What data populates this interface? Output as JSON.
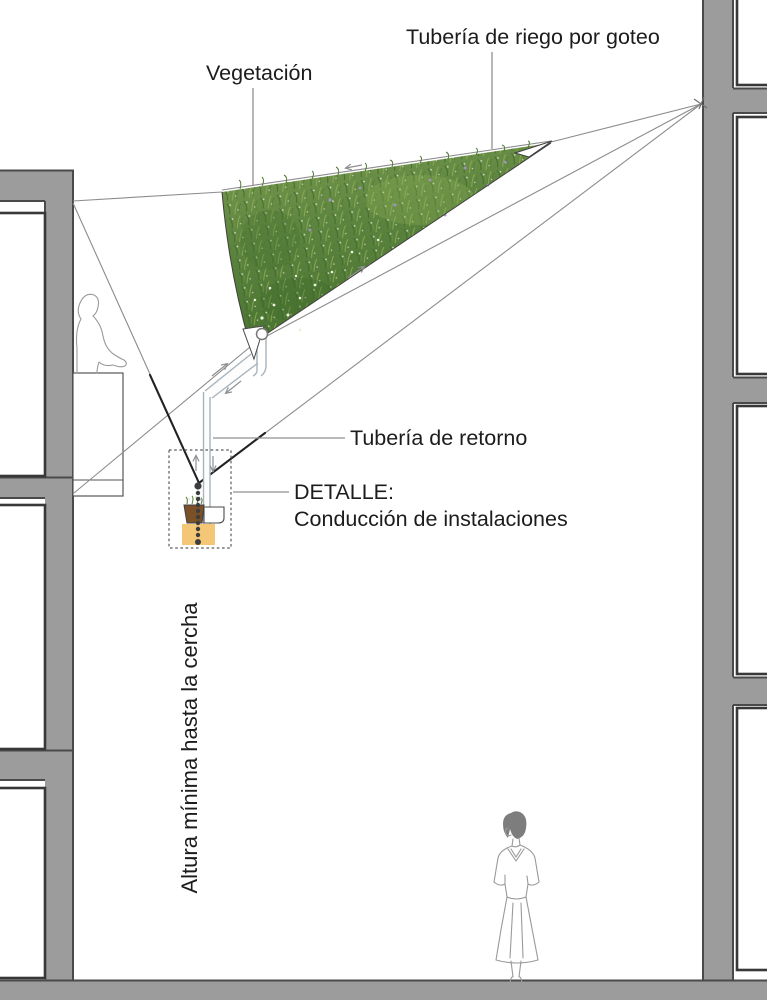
{
  "diagram": {
    "labels": {
      "drip_irrigation": "Tubería de riego por goteo",
      "vegetation": "Vegetación",
      "return_pipe": "Tubería de retorno",
      "detail_heading": "DETALLE:",
      "detail_description": "Conducción de instalaciones",
      "min_height_note": "Altura mínima hasta la cercha"
    }
  },
  "colors": {
    "wall_gray": "#9c9c9c",
    "wall_edge": "#4a4a4a",
    "opening_border": "#383838",
    "line_gray": "#8c8c8c",
    "line_dark": "#222222",
    "pipe_gray": "#a9b4bd",
    "text_color": "#1c1c1c",
    "vegetation_base": "#628a3c",
    "vegetation_dark": "#3f6a2a",
    "vegetation_light": "#8fae57",
    "flower_white": "#eef2e2",
    "flower_purple": "#a193c4",
    "soil_brown": "#7c5128",
    "detail_orange": "#f3c776",
    "figure_gray": "#9a9a9a"
  }
}
